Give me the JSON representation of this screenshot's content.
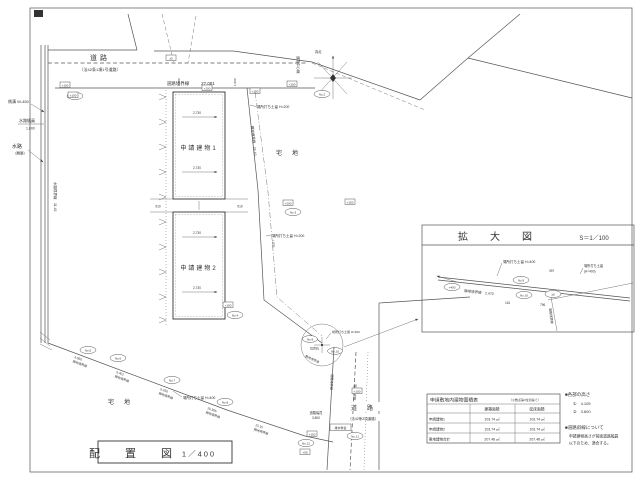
{
  "sheet": {
    "title": "配　置　図",
    "scale_label": "1／400"
  },
  "north": {
    "label": "真北"
  },
  "top_road": {
    "name": "道路",
    "kind": "〔法42条1項1号道路〕",
    "boundary_label": "道路境界線",
    "boundary_len": "27.081",
    "center_label": "道路中心線"
  },
  "waterway": {
    "gutter": "側溝 W-450",
    "width_label": "水路幅員",
    "width_value": "1,000",
    "name": "水路",
    "kind": "（開渠）",
    "boundary_label": "水路境界線　11.42"
  },
  "buildings": {
    "b1": "申請建物1",
    "b2": "申請建物2",
    "half_dim": "2,730",
    "gap_dim": "910",
    "setback_dim": "1,000"
  },
  "parcels": {
    "east": "宅　地",
    "south": "宅　地"
  },
  "east_boundary": {
    "label": "隣地境界線　25.10",
    "dim": "1,820",
    "retain_upper": "場所打ち土留 H=200",
    "retain_lower": "場所打ち土留 H=200"
  },
  "south_boundary": {
    "retain": "場所打ち土留 H=400",
    "segments": [
      {
        "len": "4.050",
        "name": "隣地境界線"
      },
      {
        "len": "5.401",
        "name": "隣地境界線"
      },
      {
        "len": "5.250",
        "name": "隣地境界線"
      },
      {
        "len": "15.305",
        "name": "隣地境界線"
      },
      {
        "len": "13.15",
        "name": "隣地境界線"
      }
    ]
  },
  "detail_point": {
    "retain": "場所打ち土留 H=400",
    "marker": "境界石",
    "boundary": "敷地境界線"
  },
  "south_road": {
    "name": "道　路",
    "kind": "〔法42条2項道路〕",
    "boundary_label": "道路境界線",
    "setback_label": "道路後退線",
    "width_label": "道路幅員",
    "width_value": "3,800",
    "manhole": "排水桝蓋"
  },
  "points": [
    "No.1",
    "No.2",
    "No.3",
    "No.4",
    "No.5",
    "No.6",
    "No.7",
    "No.8",
    "No.9",
    "No.10",
    "No.11",
    "No.12"
  ],
  "levels": [
    "+150",
    "+100",
    "±0",
    "+200",
    "+150",
    "+100",
    "+200",
    "+150",
    "+100",
    "+50",
    "+400",
    "±0"
  ],
  "enlarged": {
    "title": "拡　大　図",
    "scale": "S＝1／100",
    "boundary": "隣地境界線　2.470",
    "retain_left": "場所打ち土留 H=400",
    "retain_right_1": "場所打ち土留",
    "retain_right_2": "(H=400)",
    "road_boundary": "道路境界線",
    "dim1": "397",
    "dim2": "161",
    "dim3": "796",
    "pt1": "No.9",
    "pt2": "No.10"
  },
  "area_table": {
    "title": "申請敷地内建物面積表",
    "note": "（小数点第3位切捨て）",
    "col_building": "建築面積",
    "col_floor": "延床面積",
    "rows": [
      {
        "label": "申請建物1",
        "building": "103.74 ㎡",
        "floor": "103.74 ㎡"
      },
      {
        "label": "申請建物2",
        "building": "103.74 ㎡",
        "floor": "103.74 ㎡"
      },
      {
        "label": "敷地建物合計",
        "building": "207.48 ㎡",
        "floor": "207.48 ㎡"
      }
    ]
  },
  "notes": {
    "heights_title": "■各部の高さ",
    "h1": "①　4.105",
    "h2": "②　3.600",
    "slope_title": "■道路斜線について",
    "slope_line1": "申請建物高さが前面道路幅員",
    "slope_line2": "以下のため、適合する。"
  }
}
